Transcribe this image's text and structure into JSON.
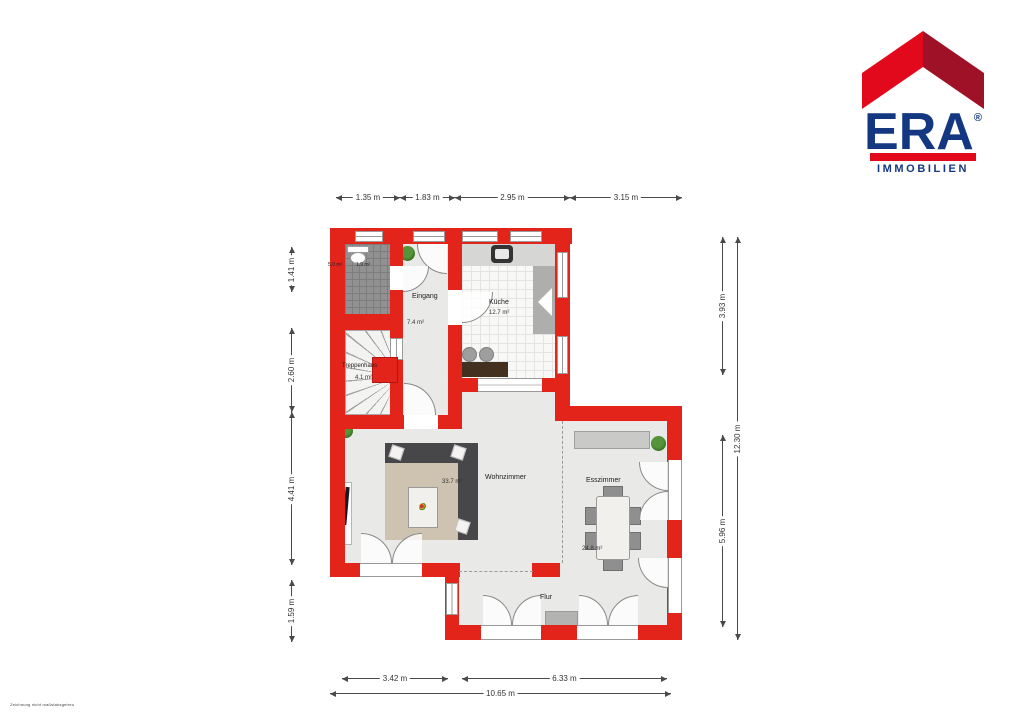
{
  "logo": {
    "brand": "ERA",
    "registered": "®",
    "subtitle": "IMMOBILIEN",
    "colors": {
      "roof_left": "#e2091c",
      "roof_right": "#9f1126",
      "text_blue": "#143781",
      "bar_red": "#e2091c"
    }
  },
  "plan": {
    "wall_color": "#e2241b",
    "rooms": {
      "wc": {
        "area_left": "5.0 m²",
        "area_right": "1.9 m²"
      },
      "eingang": {
        "name": "Eingang",
        "area": "7.4 m²"
      },
      "kueche": {
        "name": "Küche",
        "area": "12.7 m²"
      },
      "treppenhaus": {
        "name": "Treppenhaus",
        "area": "4.1 m²"
      },
      "wohnzimmer": {
        "name": "Wohnzimmer",
        "area": "33.7 m²"
      },
      "esszimmer": {
        "name": "Esszimmer",
        "area": "24.8 m²"
      },
      "flur": {
        "name": "Flur"
      }
    }
  },
  "dimensions": {
    "top": [
      "1.35 m",
      "1.83 m",
      "2.95 m",
      "3.15 m"
    ],
    "left": [
      "1.41 m",
      "2.60 m",
      "4.41 m",
      "1.59 m"
    ],
    "right_inner": [
      "3.93 m",
      "5.96 m"
    ],
    "right_outer": "12.30 m",
    "bottom_inner": [
      "3.42 m",
      "6.33 m"
    ],
    "bottom_outer": "10.65 m"
  },
  "footnote": "Zeichnung nicht maßstabsgetreu"
}
